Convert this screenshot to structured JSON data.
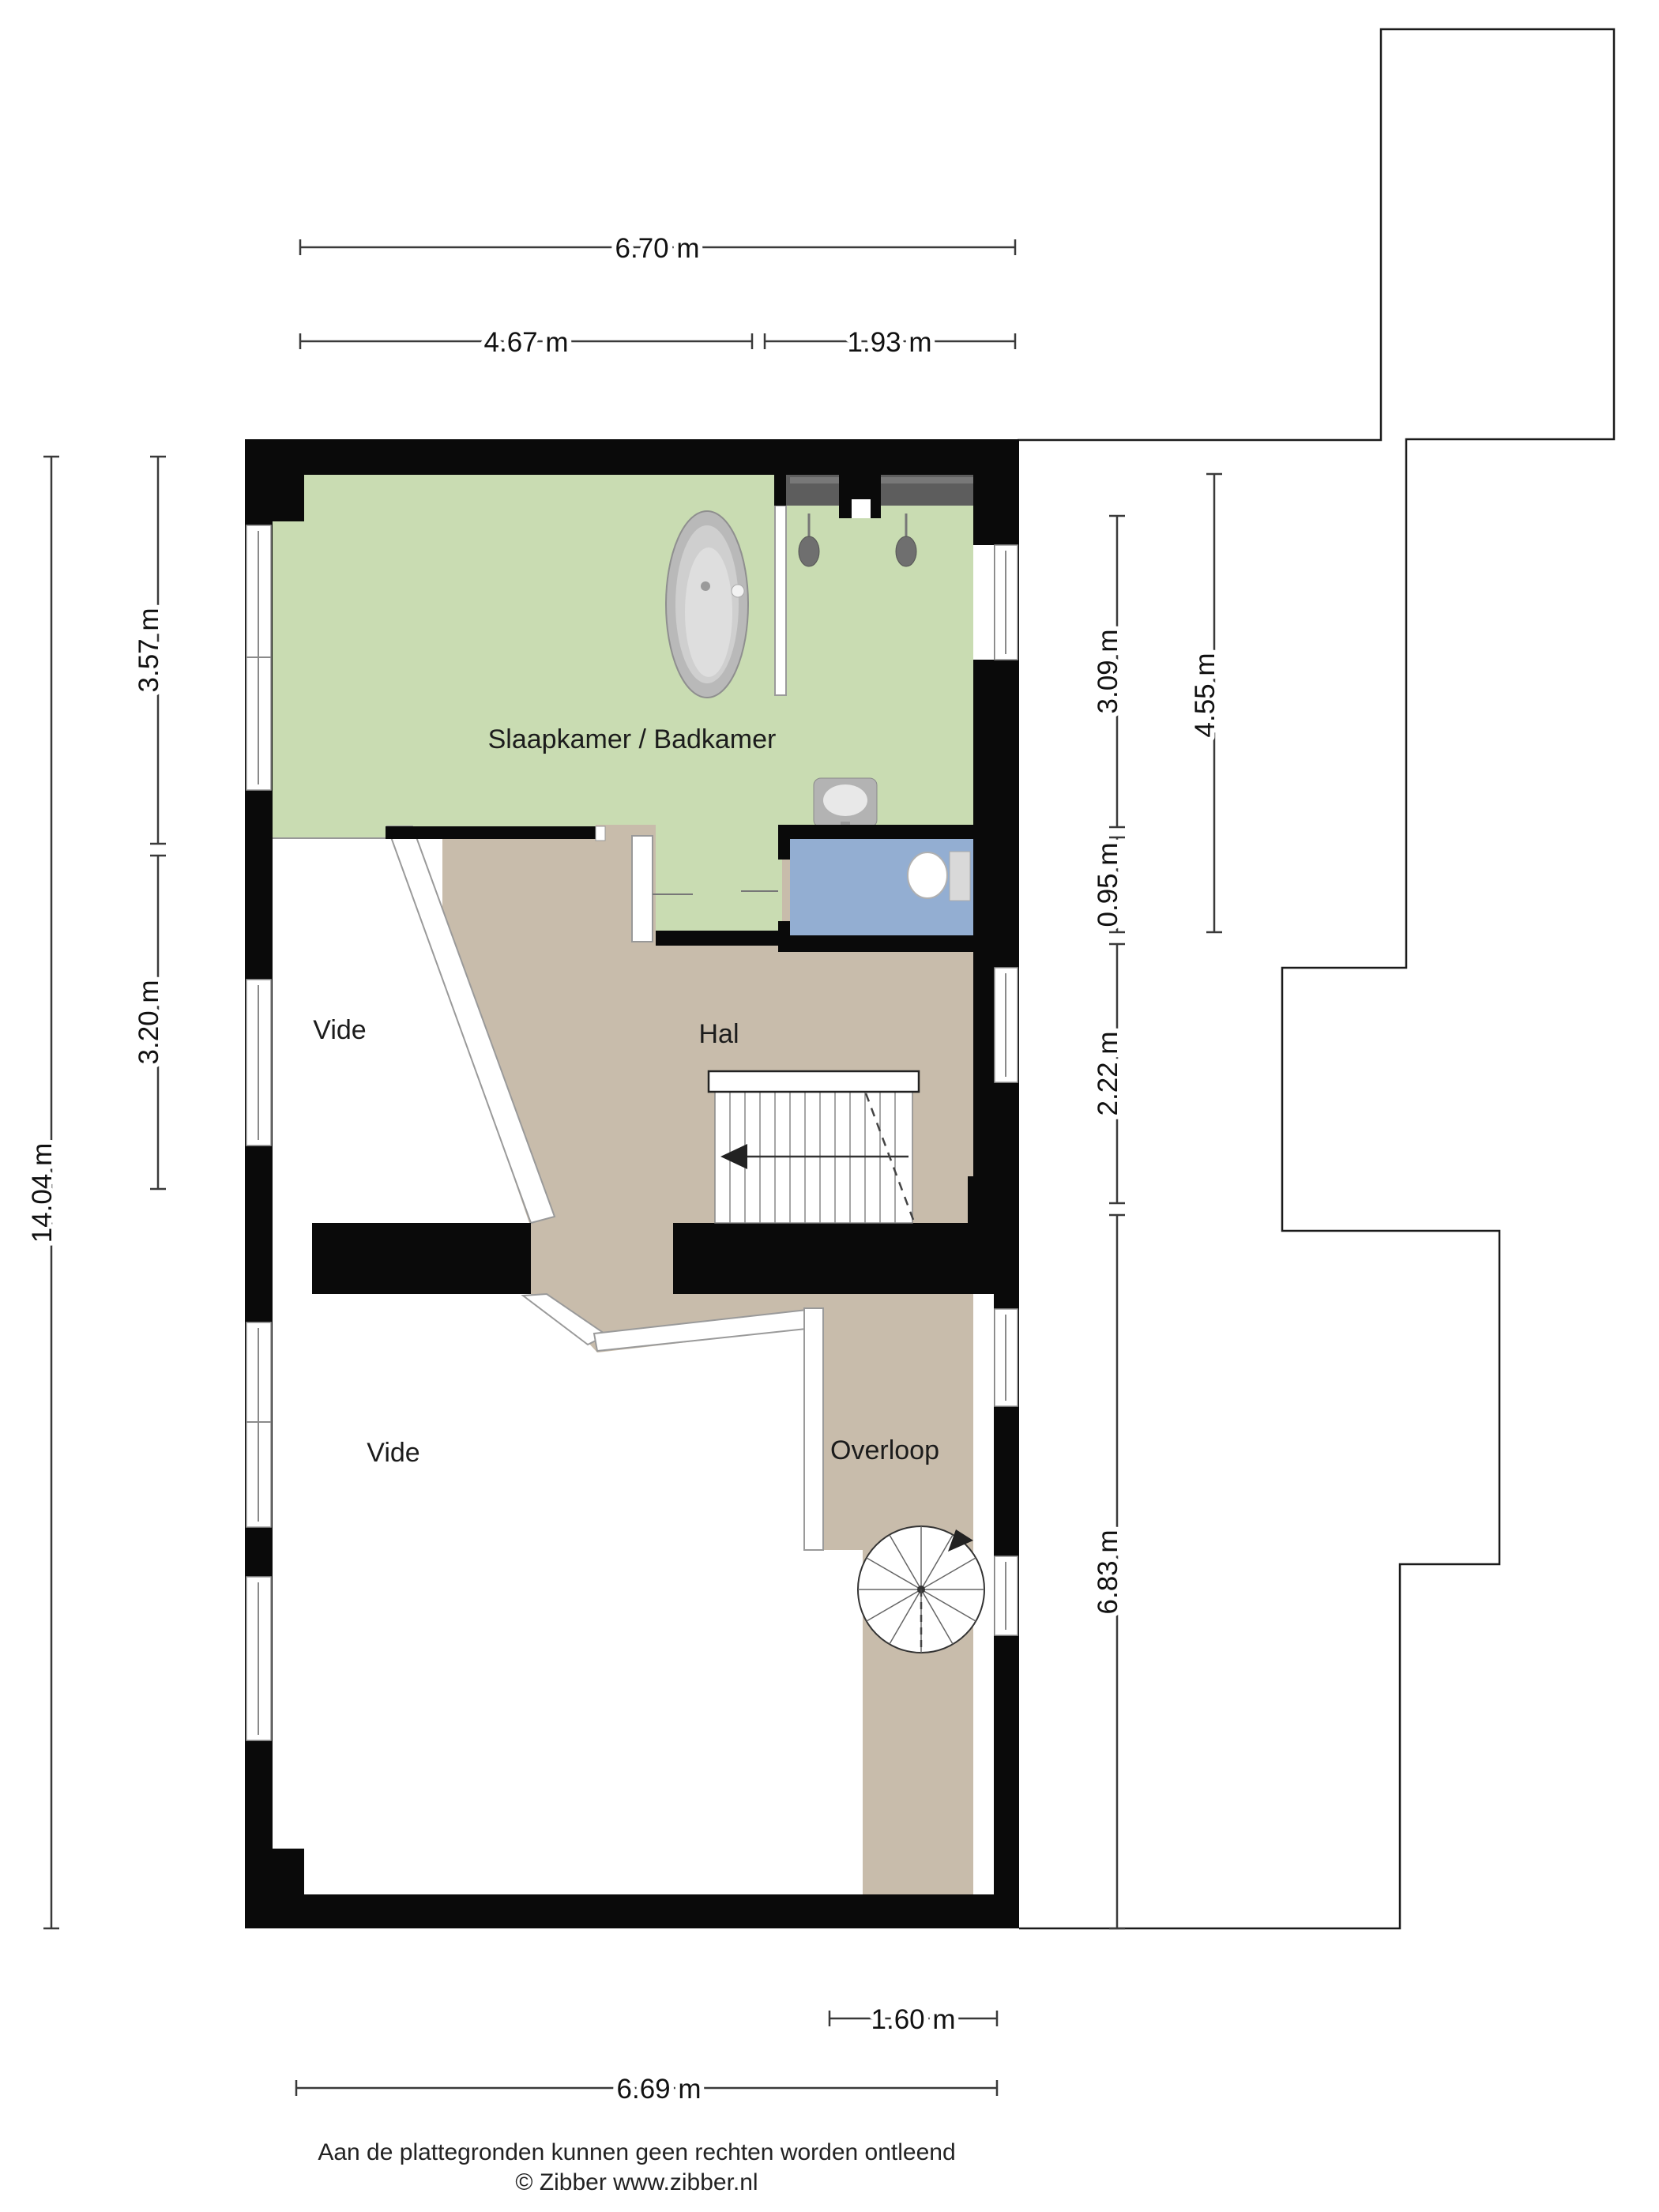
{
  "plan": {
    "rooms": [
      {
        "name": "slaapkamer-badkamer",
        "label": "Slaapkamer / Badkamer"
      },
      {
        "name": "vide-boven",
        "label": "Vide"
      },
      {
        "name": "hal",
        "label": "Hal"
      },
      {
        "name": "vide-onder",
        "label": "Vide"
      },
      {
        "name": "overloop",
        "label": "Overloop"
      }
    ],
    "colors": {
      "room_green": "#c9dcb2",
      "room_tan": "#c8bcab",
      "room_blue": "#93aed2",
      "wall": "#0a0a0a",
      "shower_niche": "#5d5d5d"
    }
  },
  "dimensions": {
    "top": [
      {
        "label": "6.70 m"
      },
      {
        "label": "4.67 m"
      },
      {
        "label": "1.93 m"
      }
    ],
    "left": [
      {
        "label": "14.04 m"
      },
      {
        "label": "3.57 m"
      },
      {
        "label": "3.20 m"
      }
    ],
    "right": [
      {
        "label": "3.09 m"
      },
      {
        "label": "0.95 m"
      },
      {
        "label": "2.22 m"
      },
      {
        "label": "6.83 m"
      },
      {
        "label": "4.55 m"
      }
    ],
    "bottom": [
      {
        "label": "1.60 m"
      },
      {
        "label": "6.69 m"
      }
    ]
  },
  "footer": {
    "disclaimer": "Aan de plattegronden kunnen geen rechten worden ontleend",
    "copyright": "© Zibber www.zibber.nl"
  }
}
